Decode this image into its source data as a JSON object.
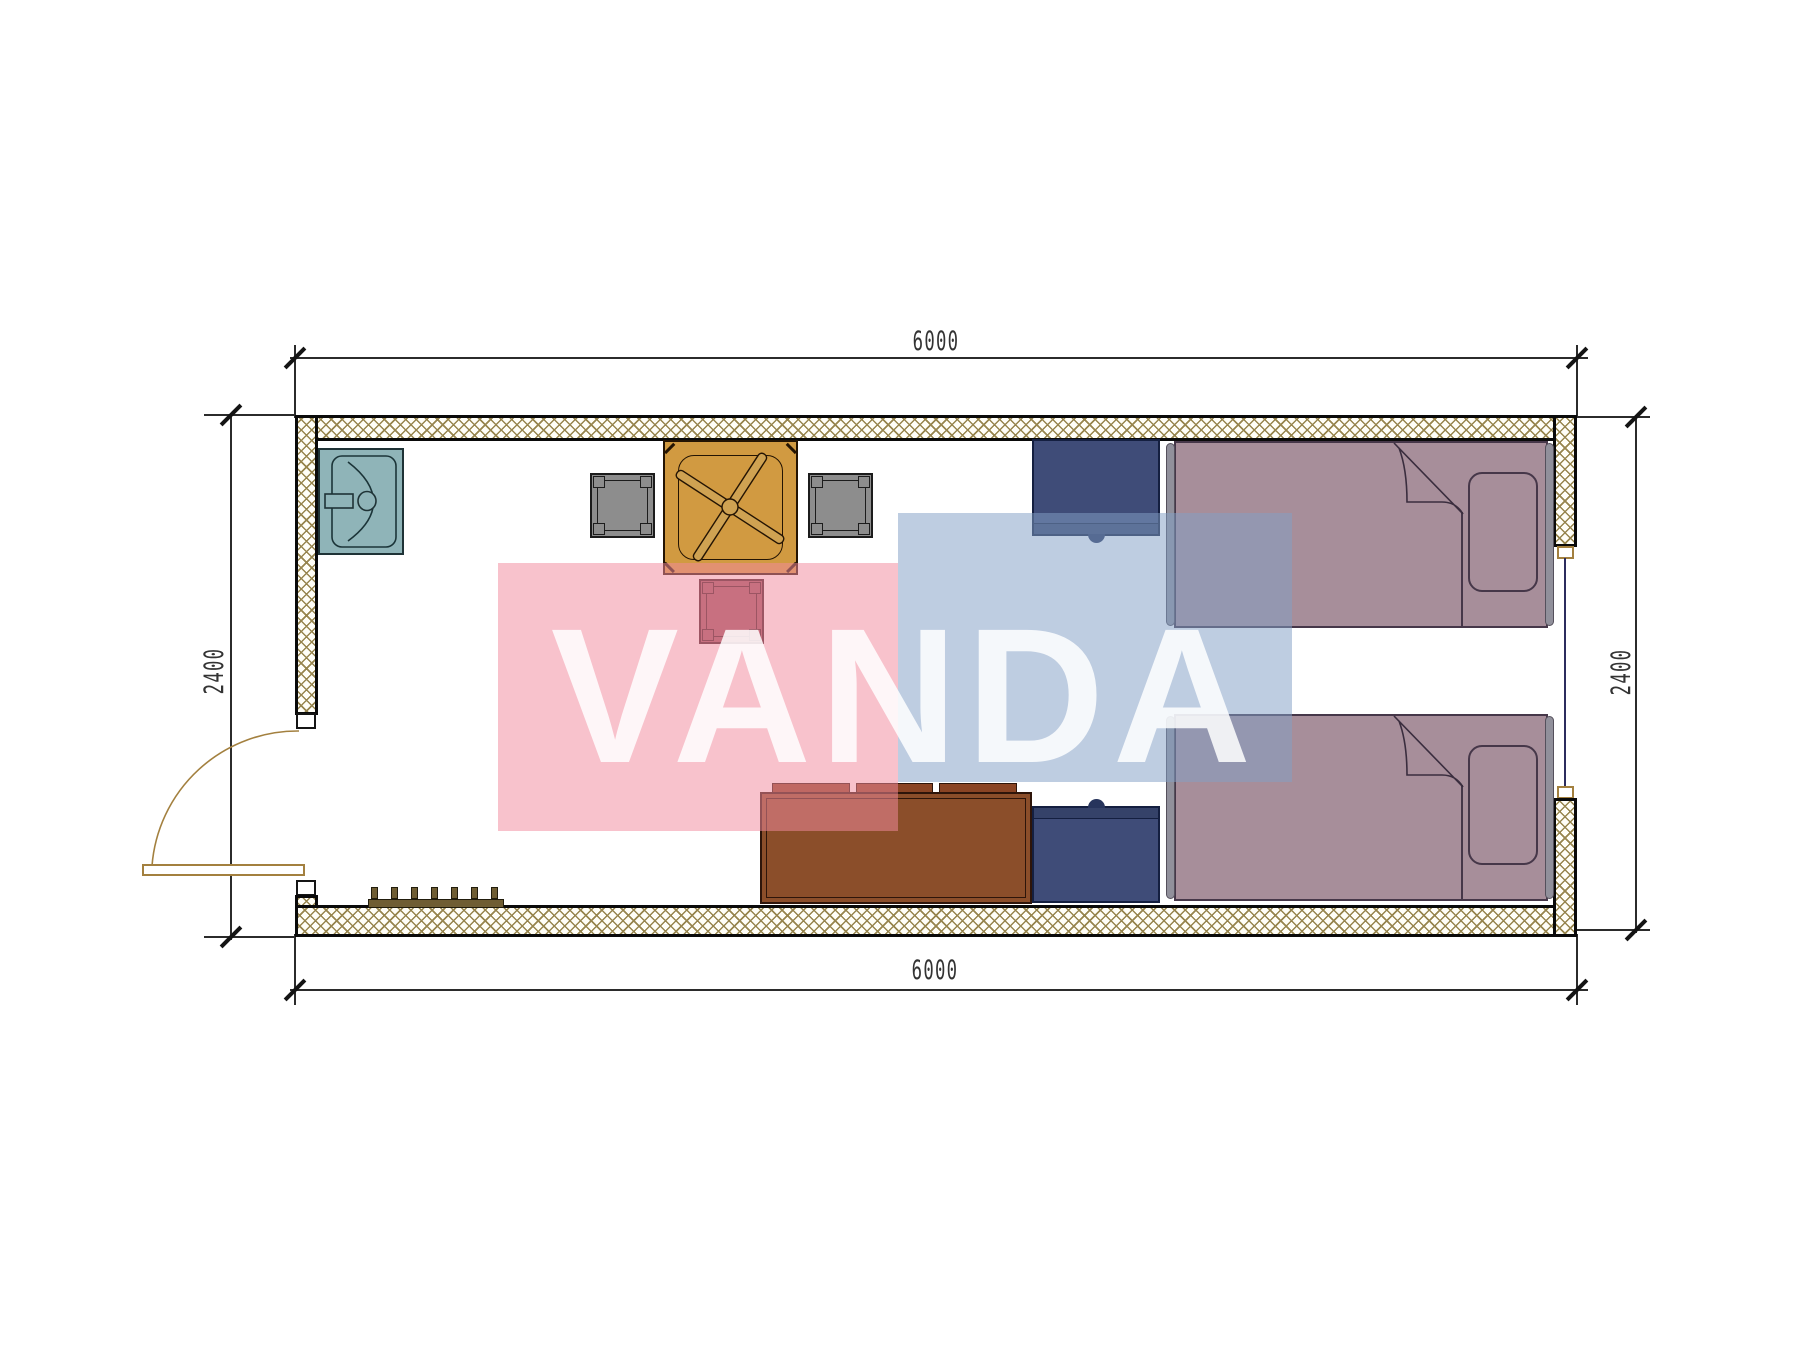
{
  "dimensions": {
    "top": "6000",
    "bottom": "6000",
    "left": "2400",
    "right": "2400"
  },
  "watermark": {
    "text": "VANDA",
    "pink_rect_color": "#f28b9e",
    "blue_rect_color": "#82a0c6",
    "text_color": "#ffffff"
  },
  "colors": {
    "wall_hatch": "#97854e",
    "wall_line": "#0a0a0a",
    "dimension_line": "#2b2b2b",
    "sink_fill": "#8fb4b8",
    "table_fill": "#d19a41",
    "fan_blade": "#cfa252",
    "stool_gray_fill": "#8d8d8d",
    "stool_red_fill": "#9b5560",
    "nightstand_fill": "#3f4c78",
    "bed_fill": "#a78e9a",
    "sofa_fill": "#8b4e2a",
    "sofa_cushion": "#8a4424",
    "door_line": "#a3803f",
    "window_line": "#2c2c5e",
    "coat_rack": "#6f5d33"
  },
  "furniture": [
    {
      "name": "sink"
    },
    {
      "name": "table-with-ceiling-fan"
    },
    {
      "name": "stool-gray-left"
    },
    {
      "name": "stool-gray-right"
    },
    {
      "name": "stool-red"
    },
    {
      "name": "nightstand-top"
    },
    {
      "name": "nightstand-bottom"
    },
    {
      "name": "bed-top"
    },
    {
      "name": "bed-bottom"
    },
    {
      "name": "sofa"
    },
    {
      "name": "coat-rack"
    },
    {
      "name": "door"
    },
    {
      "name": "window"
    }
  ]
}
